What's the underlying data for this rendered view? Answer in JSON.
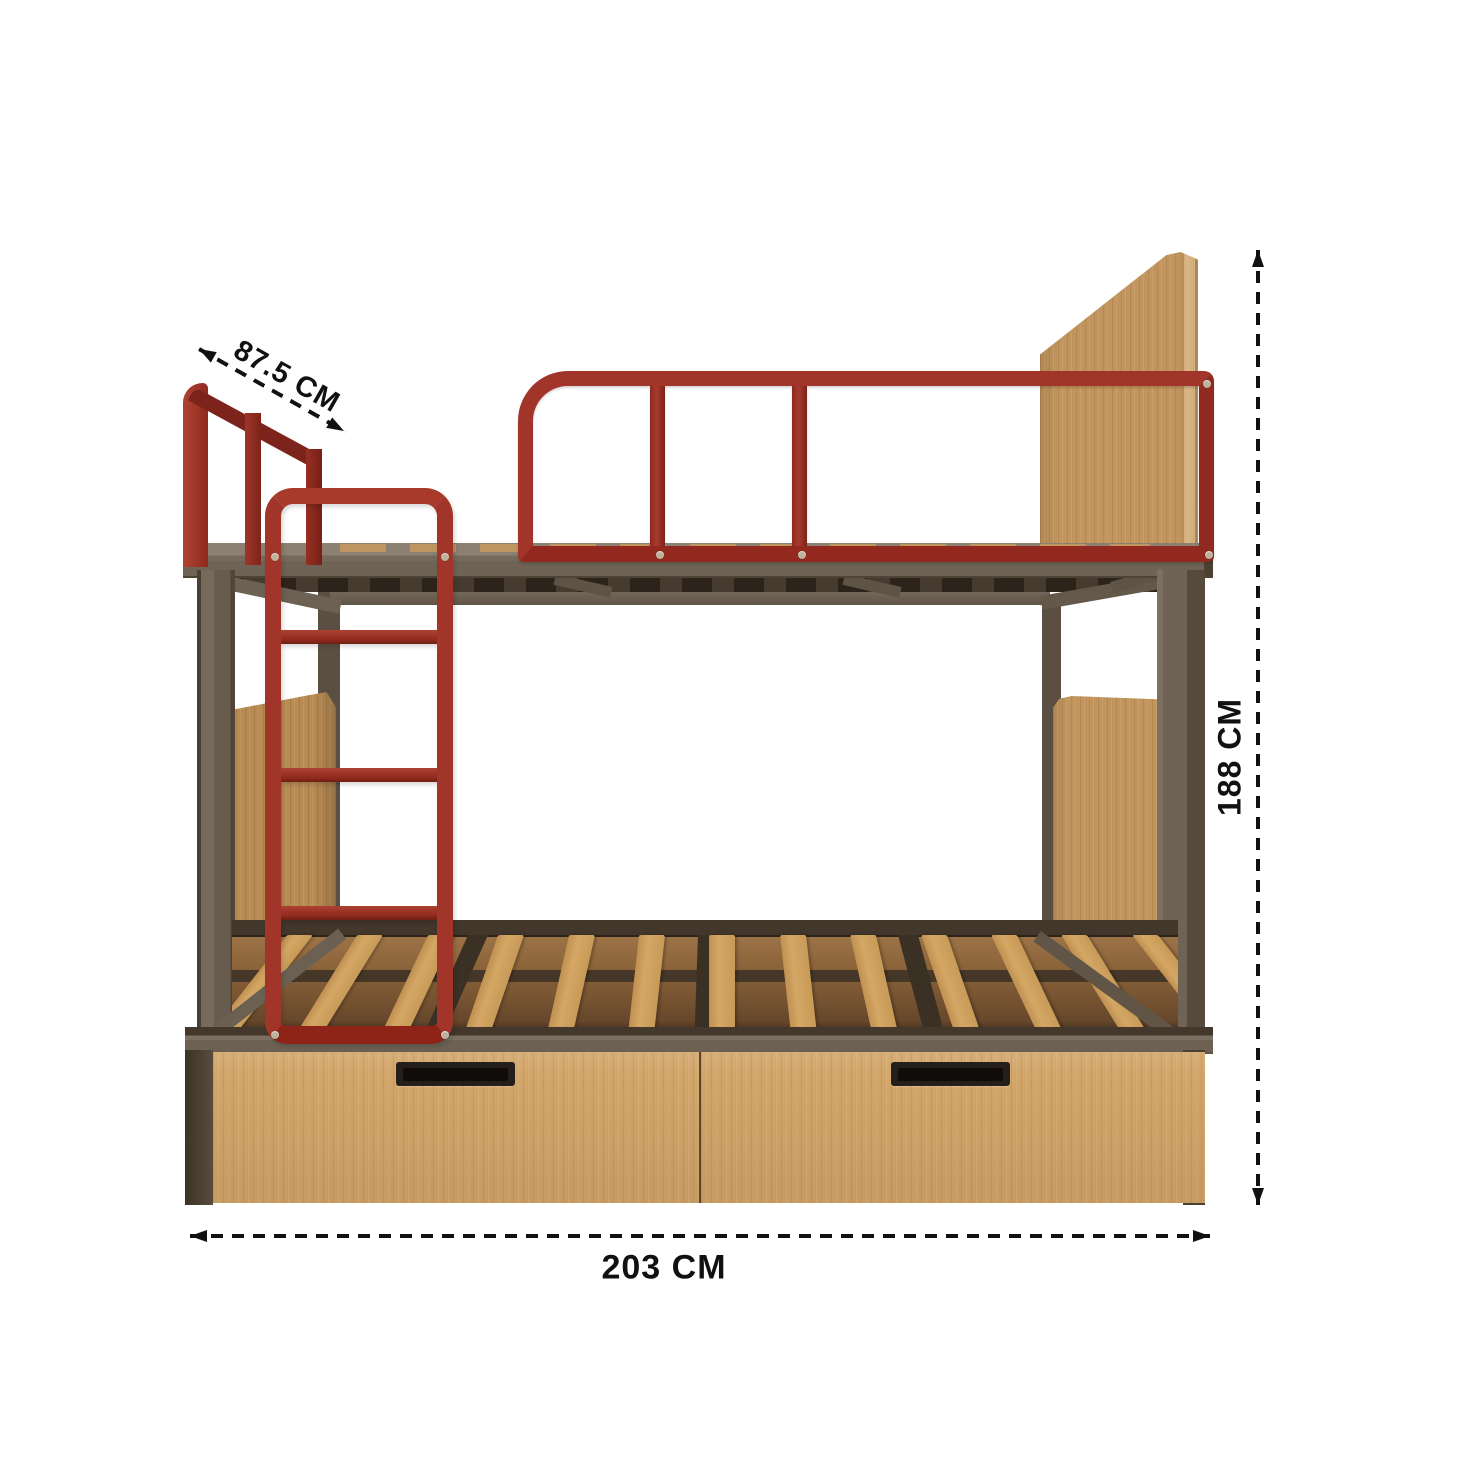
{
  "description": "Dimension diagram of a bunk bed with red steel guardrails and ladder, wooden headboards, slatted lower bunk and two storage drawers",
  "dimensions": {
    "depth": {
      "label": "87.5 CM"
    },
    "height": {
      "label": "188 CM"
    },
    "width": {
      "label": "203 CM"
    }
  },
  "bed": {
    "slat_count": 13,
    "ladder_rung_count": 3,
    "guardrail_divider_count": 2,
    "drawer_count": 2,
    "support_beam_count": 3,
    "brace_count": 3
  },
  "colors": {
    "bg": "#FFFFFF",
    "red": "#A1352A",
    "red_bright": "#AF4334",
    "red_dark": "#8E2A1F",
    "red_deep": "#6B1A12",
    "frame": "#6E6355",
    "frame_light": "#877C6D",
    "frame_dark": "#4C4033",
    "frame_deep": "#463B2E",
    "wood": "#C2955E",
    "wood_dark": "#B98C55",
    "wood_light": "#DCB77F",
    "slat": "#D4A765",
    "floor": "#8A6239",
    "drawer": "#D2A569",
    "seam": "#5E442A",
    "handle": "#241F19",
    "handle_slot": "#0F0C09",
    "screw": "#BFB19C",
    "dim": "#111111"
  }
}
